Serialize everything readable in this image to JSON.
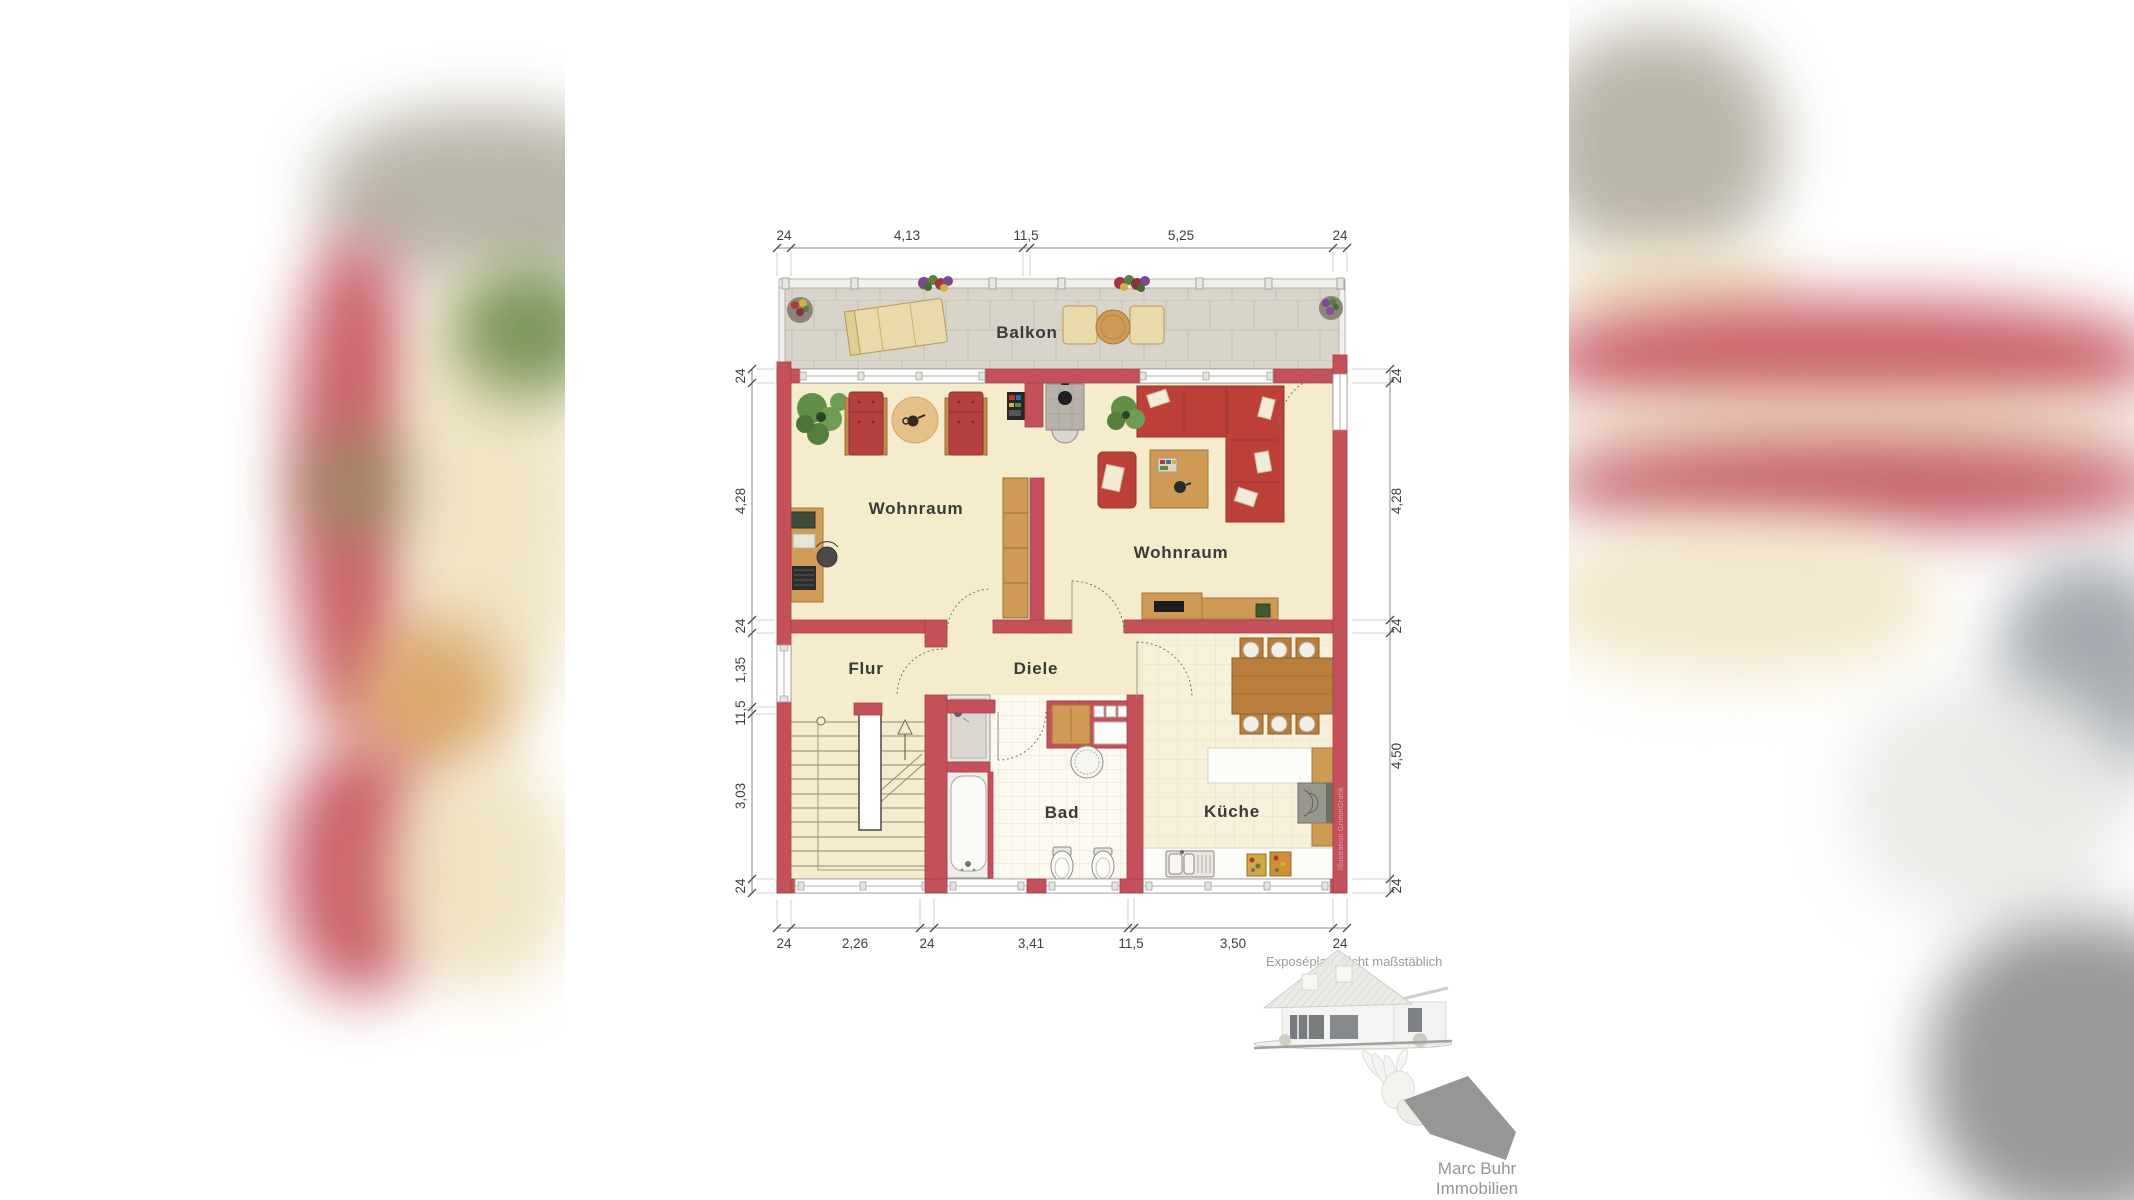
{
  "plan": {
    "rooms": {
      "balkon": "Balkon",
      "wohnraum_left": "Wohnraum",
      "wohnraum_right": "Wohnraum",
      "flur": "Flur",
      "diele": "Diele",
      "bad": "Bad",
      "kueche": "Küche"
    },
    "dimensions": {
      "top": [
        "24",
        "4,13",
        "11,5",
        "5,25",
        "24"
      ],
      "bottom": [
        "24",
        "2,26",
        "24",
        "3,41",
        "11,5",
        "3,50",
        "24"
      ],
      "left": [
        "24",
        "4,28",
        "24",
        "1,35",
        "11,5",
        "3,03",
        "24"
      ],
      "right": [
        "24",
        "4,28",
        "24",
        "4,50",
        "24"
      ]
    },
    "disclaimer": "Exposéplan, nicht maßstäblich",
    "watermark": "Illustration GrimmGrafik"
  },
  "branding": {
    "name_line1": "Marc Buhr",
    "name_line2": "Immobilien"
  },
  "colors": {
    "wall": "#c4505a",
    "floor": "#f5ecce",
    "balcony_tile": "#d8d4ca",
    "bath_tile": "#fcf9f1",
    "kitchen_tile": "#f7f0db",
    "wood": "#cf9a55",
    "sofa": "#bc4038",
    "dim_text": "#3f3f3f"
  }
}
